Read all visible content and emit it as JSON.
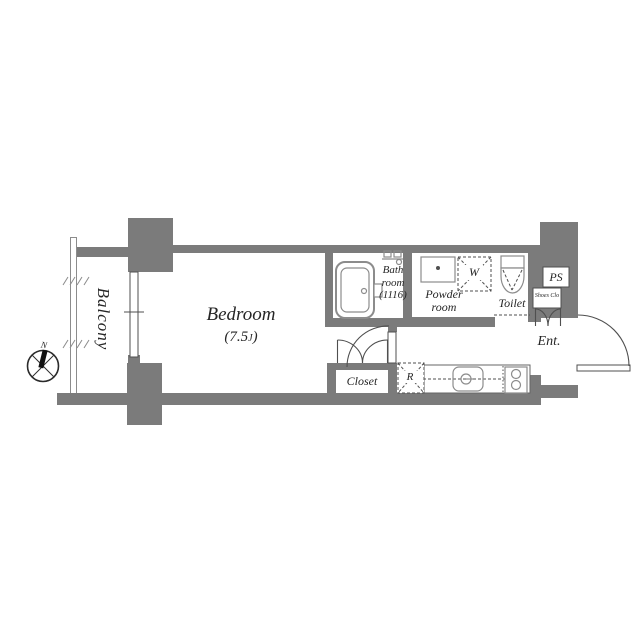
{
  "rooms": {
    "balcony": "Balcony",
    "bedroom": "Bedroom",
    "bedroom_size_open": "(7.5",
    "bedroom_size_unit": "J",
    "bedroom_size_close": ")",
    "bath_line1": "Bath",
    "bath_line2": "room",
    "bath_line3": "(1116)",
    "powder_line1": "Powder",
    "powder_line2": "room",
    "toilet": "Toilet",
    "entrance": "Ent.",
    "closet": "Closet",
    "pipe_space": "PS",
    "shoes_closet": "Shoes Clo"
  },
  "fixtures": {
    "washer": "W",
    "refrigerator": "R"
  },
  "compass": {
    "north": "N"
  },
  "colors": {
    "wall": "#7b7b7b",
    "line": "#4f4f4f",
    "fixture": "#8c8c8c",
    "text": "#262626",
    "bg": "#ffffff"
  }
}
